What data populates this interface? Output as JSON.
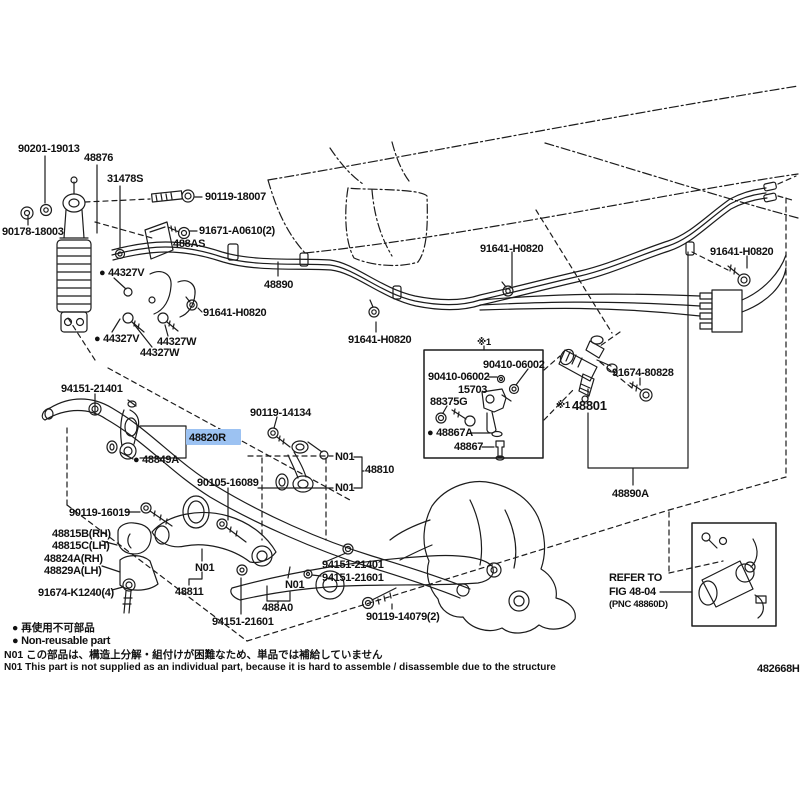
{
  "figure_code": "482668H",
  "highlight": {
    "part_label": "48820R",
    "bg": "#9cc2f2",
    "fg": "#16306e"
  },
  "labels": {
    "p90201_19013": "90201-19013",
    "p48876": "48876",
    "p31478S": "31478S",
    "p90119_18007": "90119-18007",
    "p90178_18003": "90178-18003",
    "p91671_A0610": "91671-A0610(2)",
    "p488AS": "488AS",
    "p44327V": "● 44327V",
    "p48890": "48890",
    "p91641_H0820": "91641-H0820",
    "p44327W": "44327W",
    "p94151_21401": "94151-21401",
    "p90119_14134": "90119-14134",
    "ref_mark": "※1",
    "p90410_06002": "90410-06002",
    "p15703": "15703",
    "p88375G": "88375G",
    "p48867A": "● 48867A",
    "p48867": "48867",
    "p91674_80828": "91674-80828",
    "p48801": "48801",
    "p48820R": "48820R",
    "p48849A": "● 48849A",
    "n01": "N01",
    "p48810": "48810",
    "p90105_16089": "90105-16089",
    "p90119_16019": "90119-16019",
    "p48815B": "48815B(RH)",
    "p48815C": "48815C(LH)",
    "p48824A": "48824A(RH)",
    "p48829A": "48829A(LH)",
    "p91674_K1240": "91674-K1240(4)",
    "p48811": "48811",
    "p94151_21601": "94151-21601",
    "p488A0": "488A0",
    "p90119_14079": "90119-14079(2)",
    "p48890A": "48890A"
  },
  "refer_box": {
    "line1": "REFER TO",
    "line2": "FIG 48-04",
    "line3": "(PNC 48860D)"
  },
  "legend": {
    "jp": "● 再使用不可部品",
    "en": "● Non-reusable part"
  },
  "notes": {
    "jp": "N01 この部品は、構造上分解・組付けが困難なため、単品では補給していません",
    "en": "N01 This part is not supplied as an individual part, because it is hard to assemble / disassemble due to the structure"
  }
}
